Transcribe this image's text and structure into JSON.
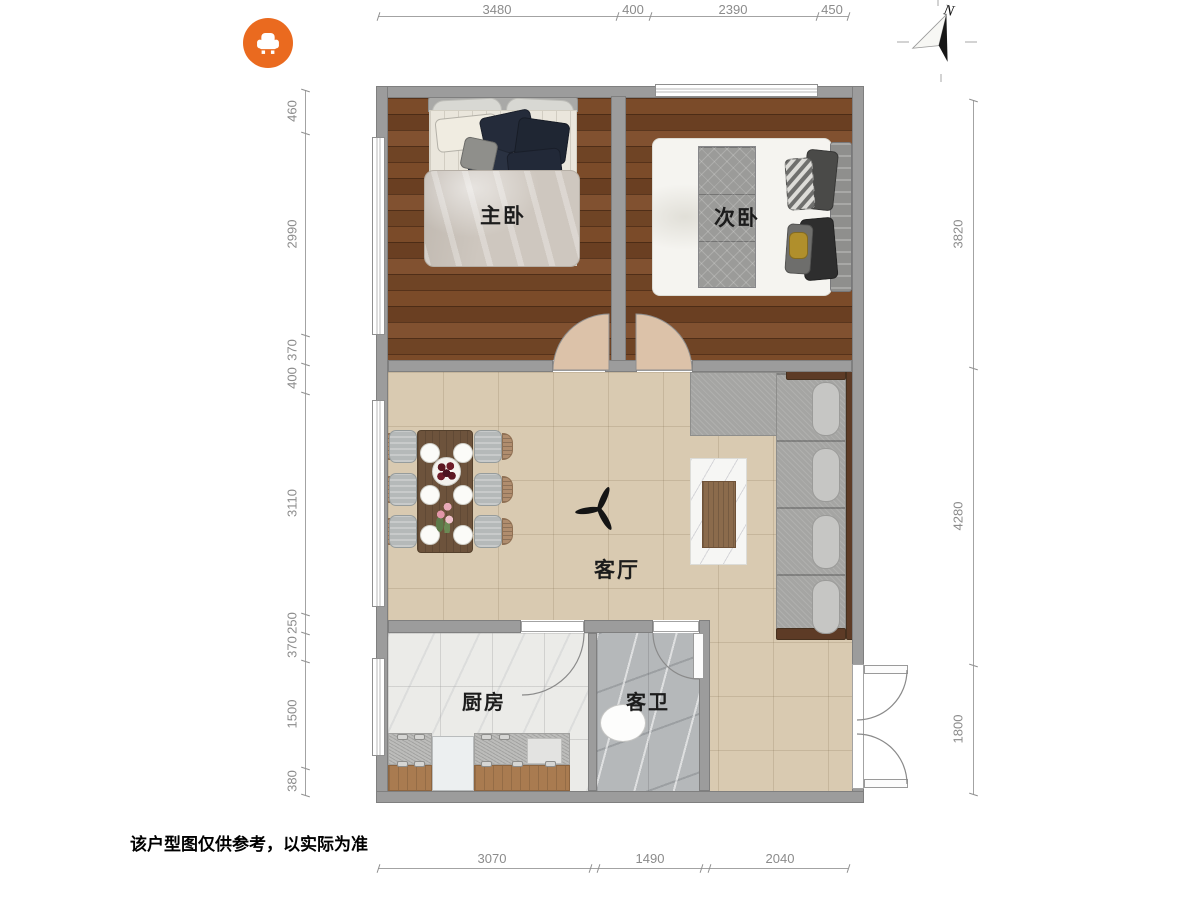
{
  "plan": {
    "disclaimer": "该户型图仅供参考，以实际为准",
    "compass_label": "N",
    "rooms": {
      "master": "主卧",
      "second": "次卧",
      "living": "客厅",
      "kitchen": "厨房",
      "bath": "客卫"
    },
    "dimensions": {
      "top": [
        "3480",
        "400",
        "2390",
        "450"
      ],
      "left": [
        "460",
        "2990",
        "370",
        "400",
        "3110",
        "250",
        "370",
        "1500",
        "380"
      ],
      "right": [
        "3820",
        "4280",
        "1800"
      ],
      "bottom": [
        "3070",
        "1490",
        "2040"
      ]
    },
    "icons": {
      "brand": "armchair-icon",
      "compass": "north-arrow-icon",
      "fan": "ceiling-fan-icon"
    },
    "colors": {
      "accent_orange": "#ea6a1f",
      "wood_floor": "#714526",
      "tile_floor": "#d9cab1",
      "wall_gray": "#9c9c9c",
      "kitchen_floor": "#ebebe8",
      "bath_floor": "#b5b8ba"
    }
  }
}
